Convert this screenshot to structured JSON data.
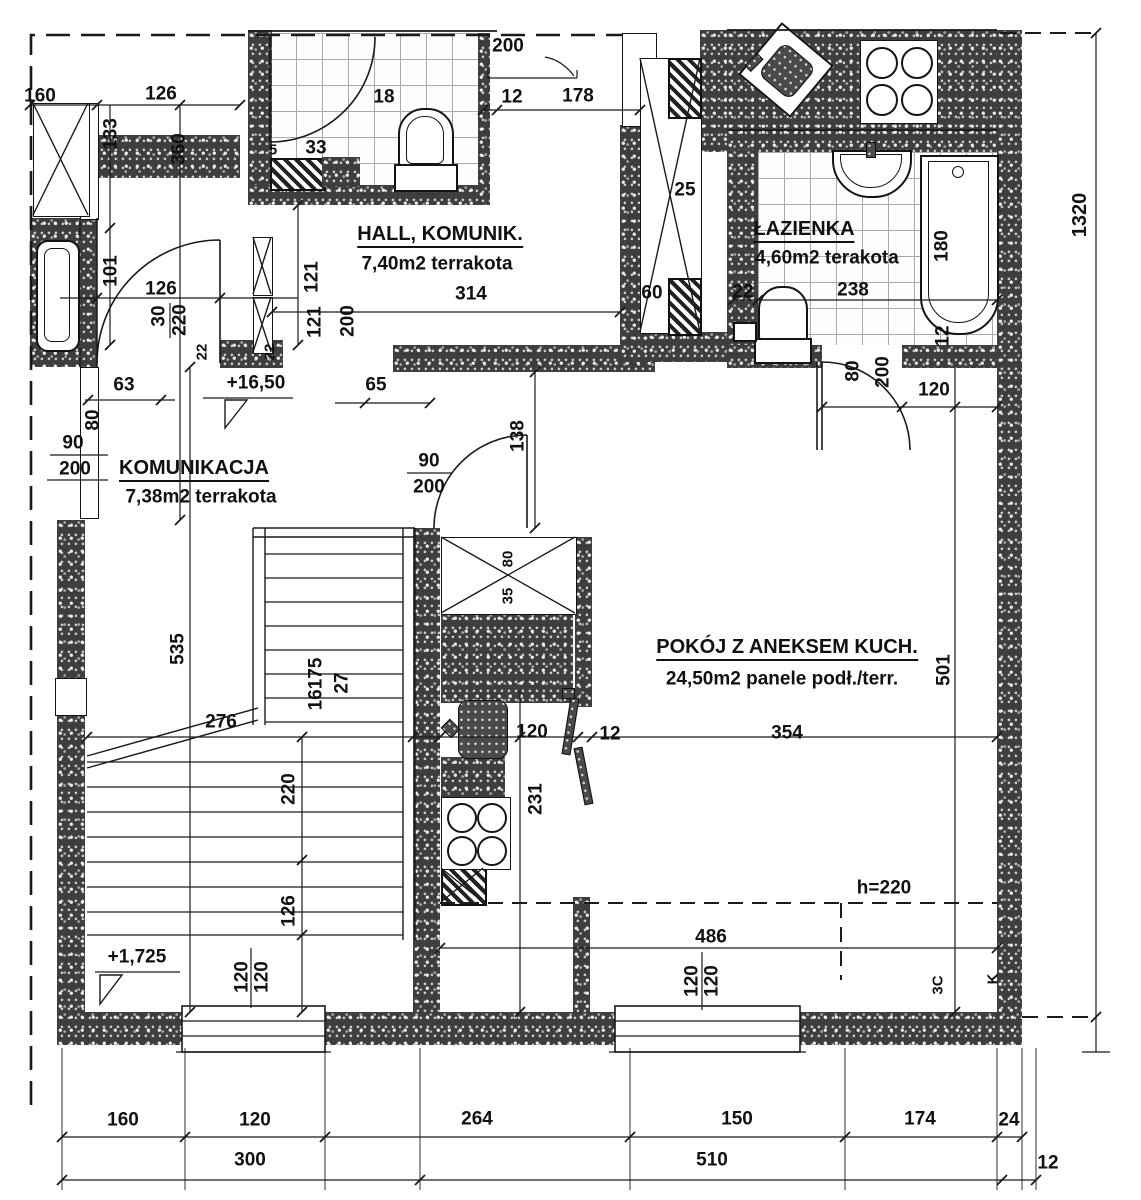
{
  "title": "apartment-floor-plan",
  "colors": {
    "wall": "#3e3e3e",
    "paper": "#ffffff",
    "line": "#1a1a1a"
  },
  "rooms": {
    "hall": {
      "name": "HALL, KOMUNIK.",
      "area": "7,40m2",
      "floor": "terrakota"
    },
    "bathroom": {
      "name": "ŁAZIENKA",
      "area": "4,60m2",
      "floor": "terakota"
    },
    "corridor": {
      "name": "KOMUNIKACJA",
      "area": "7,38m2",
      "floor": "terrakota"
    },
    "living": {
      "name": "POKÓJ Z ANEKSEM KUCH.",
      "area": "24,50m2",
      "floor": "panele podł./terr."
    }
  },
  "levels": {
    "upper": "+16,50",
    "lower": "+1,725"
  },
  "notes": {
    "ceiling": "h=220",
    "stair_steps": "16175",
    "stair_tread": "27",
    "mark_a": "3C",
    "mark_b": "K"
  },
  "dims": {
    "tl160": "160",
    "tl126": "126",
    "tl133": "133",
    "tl360": "360",
    "tl101": "101",
    "tl126b": "126",
    "tl30": "30",
    "tl220": "220",
    "tl22a": "22",
    "tl22b": "22",
    "tl121a": "121",
    "tl121b": "121",
    "tl200": "200",
    "wc18": "18",
    "wc33": "33",
    "wc5": "5",
    "wc200": "200",
    "wc12": "12",
    "wc178": "178",
    "hall314": "314",
    "hall65": "65",
    "hall63": "63",
    "l80": "80",
    "l90": "90",
    "l200": "200",
    "shaft25": "25",
    "shaft60": "60",
    "shaft80": "80",
    "shaft35": "35",
    "bath22": "22",
    "bath238": "238",
    "bath180": "180",
    "bath12": "12",
    "bd80": "80",
    "bd200": "200",
    "bd120": "120",
    "rd90": "90",
    "rd200": "200",
    "rd138": "138",
    "ax120": "120",
    "ax12": "12",
    "ax231": "231",
    "ax354": "354",
    "lv501": "501",
    "lv486": "486",
    "st535": "535",
    "st276": "276",
    "st220": "220",
    "st126": "126",
    "w1a": "120",
    "w1b": "120",
    "w2a": "120",
    "w2b": "120",
    "r1320": "1320"
  },
  "chains": {
    "row1": [
      "160",
      "120",
      "264",
      "150",
      "174",
      "24"
    ],
    "row2": [
      "300",
      "510",
      "12"
    ]
  }
}
